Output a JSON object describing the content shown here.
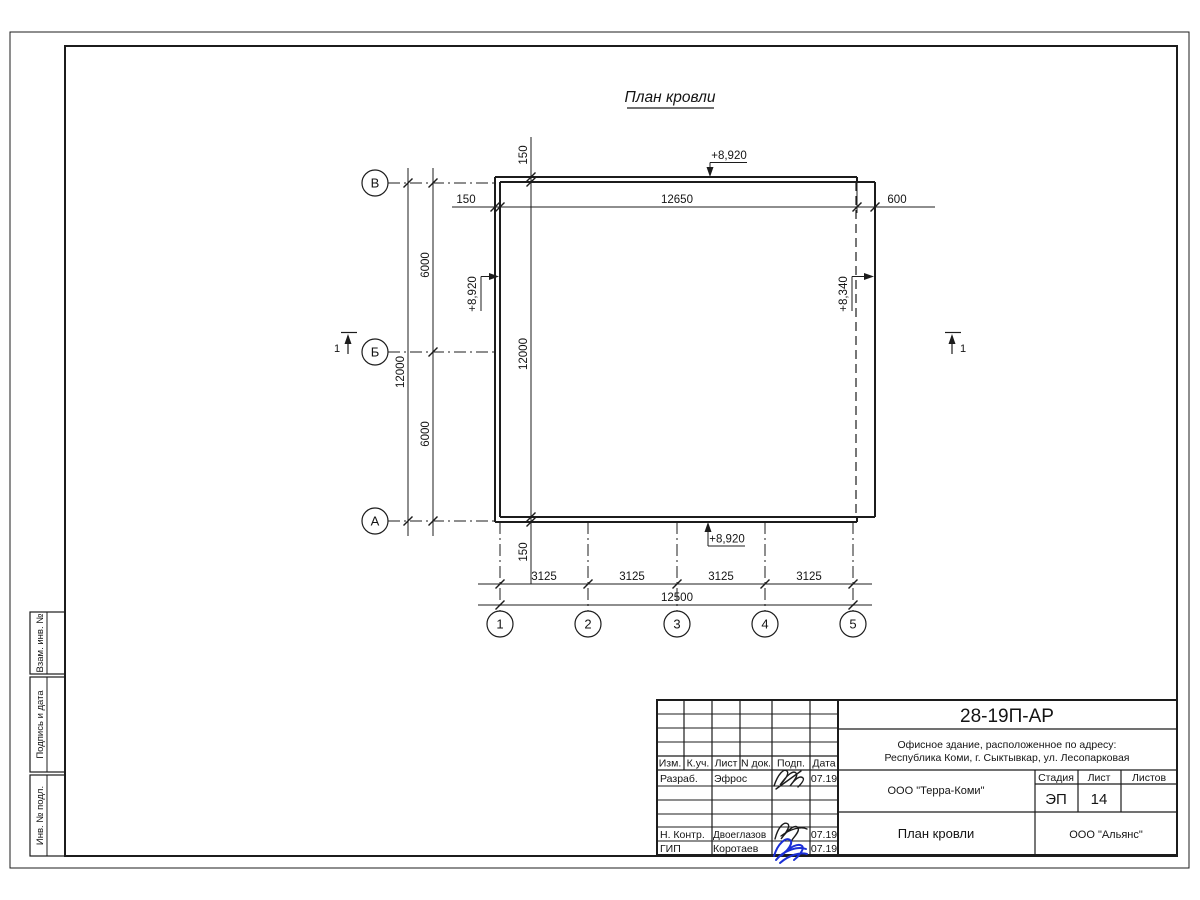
{
  "drawing": {
    "title": "План кровли",
    "axes": {
      "rows": [
        "В",
        "Б",
        "А"
      ],
      "cols": [
        "1",
        "2",
        "3",
        "4",
        "5"
      ]
    },
    "dims": {
      "top_parapet": "150",
      "top_width": "12650",
      "top_overhang": "600",
      "left_total": "12000",
      "left_spans": [
        "6000",
        "6000"
      ],
      "mid_top": "150",
      "mid_total": "12000",
      "mid_bottom": "150",
      "bottom_spans": [
        "3125",
        "3125",
        "3125",
        "3125"
      ],
      "bottom_total": "12500"
    },
    "elevations": {
      "top": "+8,920",
      "left": "+8,920",
      "right": "+8,340",
      "bottom": "+8,920"
    },
    "section_mark_left": "1",
    "section_mark_right": "1"
  },
  "side_stamp": {
    "cells": [
      "Взам. инв. №",
      "Подпись и дата",
      "Инв. № подл."
    ]
  },
  "title_block": {
    "doc_number": "28-19П-АР",
    "object_line1": "Офисное здание, расположенное по адресу:",
    "object_line2": "Республика Коми, г. Сыктывкар, ул. Лесопарковая",
    "col_headers": {
      "izm": "Изм.",
      "kuch": "К.уч.",
      "list": "Лист",
      "ndok": "N док.",
      "podp": "Подп.",
      "data": "Дата"
    },
    "rows": [
      {
        "role": "Разраб.",
        "name": "Эфрос",
        "date": "07.19"
      },
      {
        "role": "Н. Контр.",
        "name": "Двоеглазов",
        "date": "07.19"
      },
      {
        "role": "ГИП",
        "name": "Коротаев",
        "date": "07.19"
      }
    ],
    "designer_org": "ООО \"Терра-Коми\"",
    "client_org": "ООО \"Альянс\"",
    "stage_label": "Стадия",
    "sheet_label": "Лист",
    "sheets_label": "Листов",
    "stage_value": "ЭП",
    "sheet_value": "14",
    "sheets_value": "",
    "sheet_title": "План кровли"
  }
}
